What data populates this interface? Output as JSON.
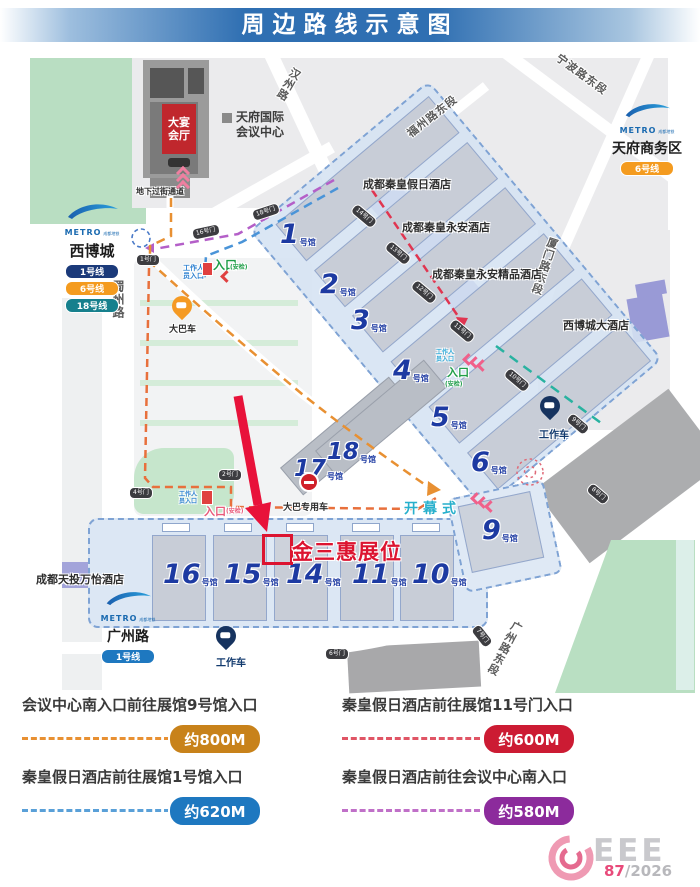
{
  "title": "周边路线示意图",
  "metro": {
    "brand": "METRO",
    "brand_sub": "成都地铁",
    "xibocheng": {
      "name": "西博城",
      "lines": [
        "1号线",
        "6号线",
        "18号线"
      ],
      "line_colors": [
        "#1b3a7a",
        "#f49b1f",
        "#16808d"
      ]
    },
    "tianfu_cbd": {
      "name": "天府商务区",
      "lines": [
        "6号线"
      ],
      "line_colors": [
        "#f49b1f"
      ]
    },
    "guangzhoulu": {
      "name": "广州路",
      "lines": [
        "1号线"
      ],
      "line_colors": [
        "#1e78c0"
      ]
    }
  },
  "roads": {
    "hanzhoulu": "汉州路",
    "ningbolu": "宁波路东段",
    "fuzhoulu": "福州路东段",
    "xiamenlu": "厦门路东段",
    "shuzhoulu": "蜀州路",
    "guangzhoulu_east": "广州路东段"
  },
  "places": {
    "convention_l1": "天府国际",
    "convention_l2": "会议中心",
    "ballroom_l1": "大宴",
    "ballroom_l2": "会厅",
    "underpass": "地下过街通道",
    "hotel_qinhuang_holiday": "成都秦皇假日酒店",
    "hotel_qinhuang_yongan": "成都秦皇永安酒店",
    "hotel_qinhuang_yongan_boutique": "成都秦皇永安精品酒店",
    "hotel_xibocheng": "西博城大酒店",
    "hotel_tiantou_wanyi": "成都天投万怡酒店",
    "opening_ceremony": "开幕式",
    "bus": "大巴车",
    "bus_only": "大巴专用车",
    "work_car": "工作车"
  },
  "entrance": {
    "staff_l1": "工作人",
    "staff_l2": "员入口",
    "gate": "入口",
    "security": "(安检)"
  },
  "booth": {
    "label": "金三惠展位",
    "color": "#dc1430"
  },
  "hall_suffix": "号馆",
  "halls": {
    "1": "1",
    "2": "2",
    "3": "3",
    "4": "4",
    "5": "5",
    "6": "6",
    "9": "9",
    "10": "10",
    "11": "11",
    "14": "14",
    "15": "15",
    "16": "16",
    "17": "17",
    "18": "18"
  },
  "gates": {
    "1": "1号门",
    "2": "2号门",
    "4": "4号门",
    "6": "6号门",
    "7": "7号门",
    "8": "8号门",
    "9": "9号门",
    "10": "10号门",
    "11": "11号门",
    "12": "12号门",
    "13": "13号门",
    "14": "14号门",
    "16": "16号门",
    "18": "18号门"
  },
  "routes": {
    "colors": {
      "orange": "#e89032",
      "red": "#e03550",
      "blue": "#4a94d8",
      "purple": "#b45fc8",
      "teal": "#28b2a0"
    }
  },
  "legend": {
    "items": [
      {
        "route": "会议中心南入口前往展馆9号馆入口",
        "distance": "约800M",
        "color": "#c8821a"
      },
      {
        "route": "秦皇假日酒店前往展馆11号门入口",
        "distance": "约600M",
        "color": "#cc1b33"
      },
      {
        "route": "秦皇假日酒店前往展馆1号馆入口",
        "distance": "约620M",
        "color": "#1e78c0"
      },
      {
        "route": "秦皇假日酒店前往会议中心南入口",
        "distance": "约580M",
        "color": "#8c2b9c"
      }
    ]
  },
  "logo": {
    "brand": "CEEE",
    "letters": "EEE",
    "number": "87",
    "year": "/2026"
  }
}
